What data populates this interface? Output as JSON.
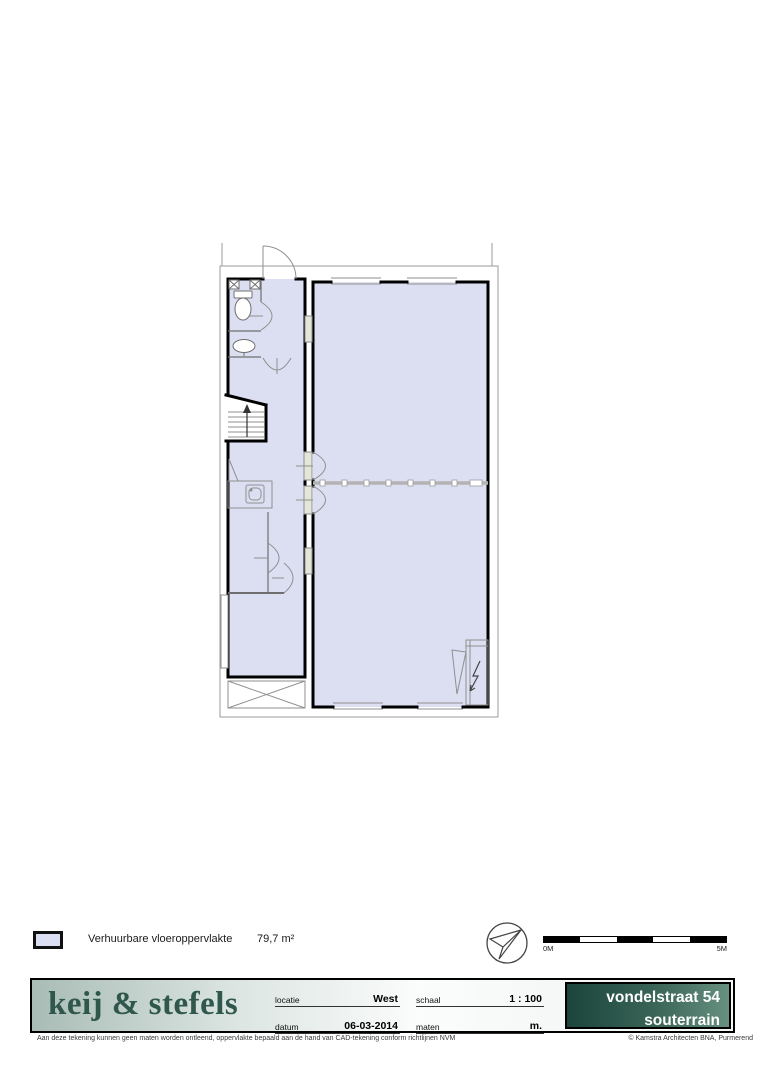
{
  "plan": {
    "area_fill_color": "#dcdff2",
    "wall_color": "#000000",
    "thin_line_color": "#8f8f8f"
  },
  "legend": {
    "label": "Verhuurbare vloeroppervlakte",
    "value": "79,7 m²",
    "swatch_color": "#dcdff2"
  },
  "scale_bar": {
    "start_label": "0M",
    "end_label": "5M"
  },
  "title_block": {
    "logo_text": "keij & stefels",
    "brand_color": "#2f574c",
    "banner_gradient_dark": "#1b453c",
    "banner_gradient_light": "#679080",
    "fields": [
      {
        "label": "locatie",
        "value": "West"
      },
      {
        "label": "datum",
        "value": "06-03-2014"
      },
      {
        "label": "schaal",
        "value": "1 : 100"
      },
      {
        "label": "maten",
        "value": "m."
      }
    ],
    "project_line1": "vondelstraat 54",
    "project_line2": "souterrain"
  },
  "footer": {
    "disclaimer": "Aan deze tekening kunnen geen maten worden ontleend, oppervlakte bepaald aan de hand van CAD-tekening conform richtlijnen NVM",
    "copyright": "© Kamstra Architecten BNA, Purmerend"
  }
}
